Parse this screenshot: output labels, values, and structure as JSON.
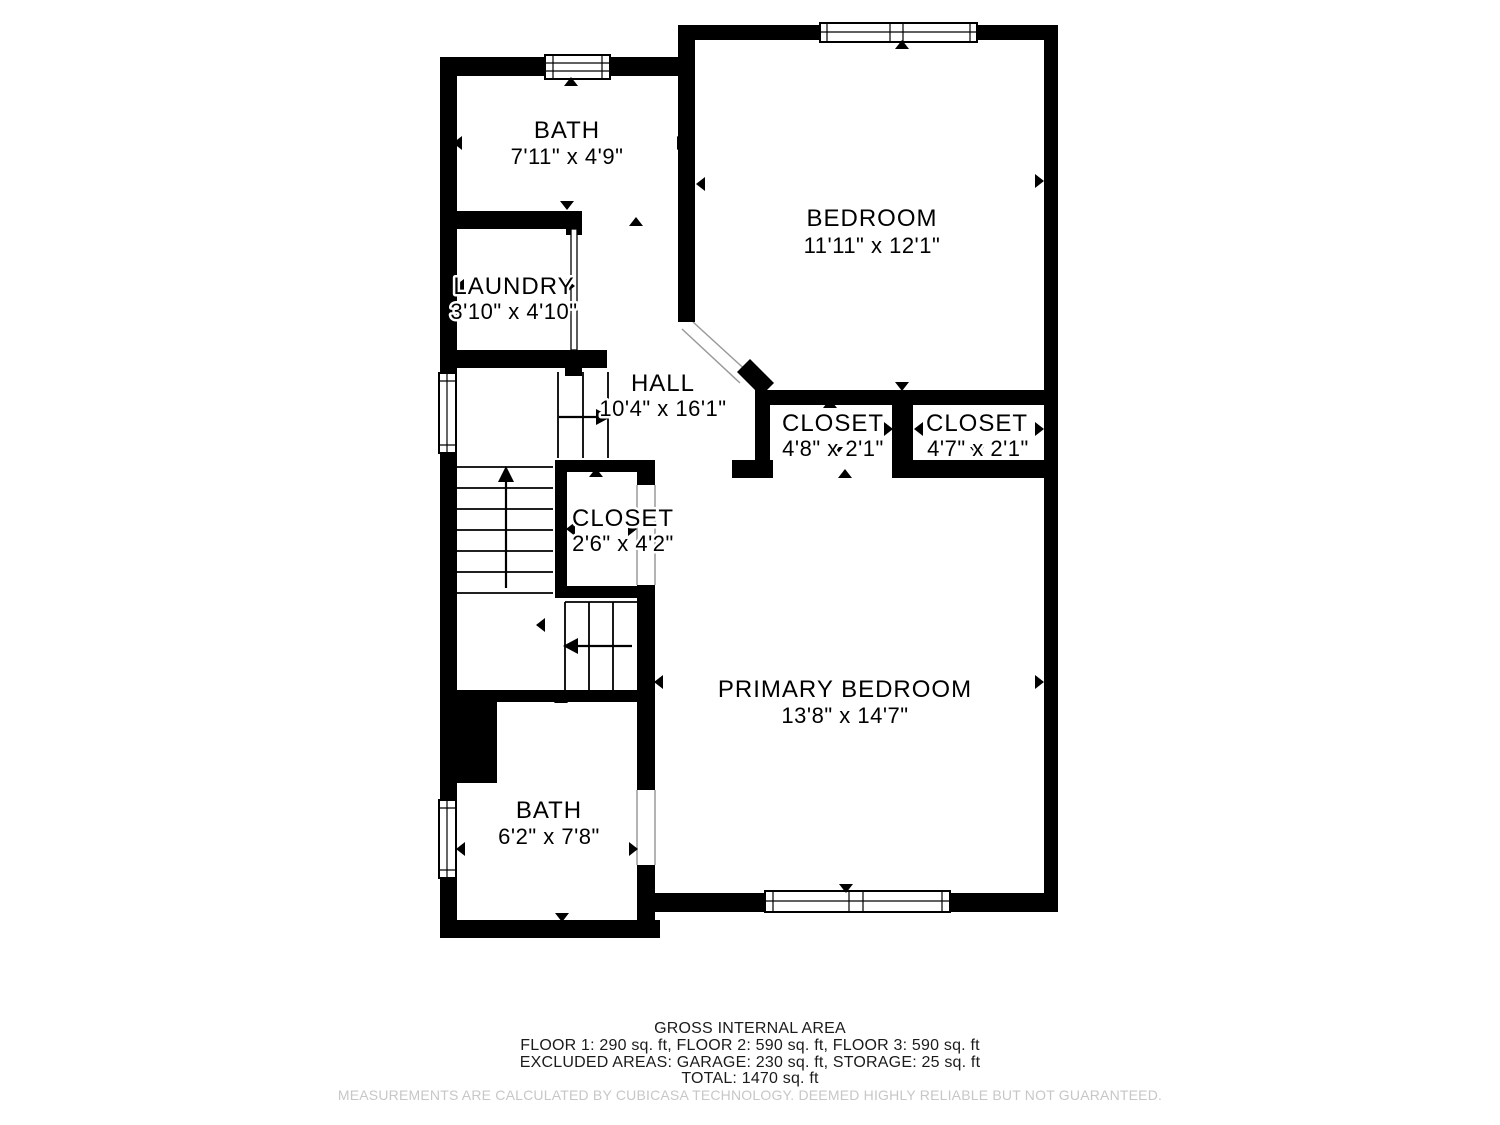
{
  "plan": {
    "title": "floor-plan-third-floor",
    "colors": {
      "wall": "#000000",
      "floor": "#ffffff",
      "label": "#000000",
      "door_guide": "#8a8a8a",
      "disclaimer_text": "#c7c7c7"
    },
    "rooms": [
      {
        "name": "BATH",
        "dims": "7'11\" x 4'9\""
      },
      {
        "name": "BEDROOM",
        "dims": "11'11\" x 12'1\""
      },
      {
        "name": "LAUNDRY",
        "dims": "3'10\" x 4'10\""
      },
      {
        "name": "HALL",
        "dims": "10'4\" x 16'1\""
      },
      {
        "name": "CLOSET",
        "dims": "4'8\" x 2'1\""
      },
      {
        "name": "CLOSET",
        "dims": "4'7\" x 2'1\""
      },
      {
        "name": "CLOSET",
        "dims": "2'6\" x 4'2\""
      },
      {
        "name": "PRIMARY BEDROOM",
        "dims": "13'8\" x 14'7\""
      },
      {
        "name": "BATH",
        "dims": "6'2\" x 7'8\""
      }
    ]
  },
  "footer": {
    "title": "GROSS INTERNAL AREA",
    "floors_line": "FLOOR 1: 290 sq. ft, FLOOR 2: 590 sq. ft, FLOOR 3: 590 sq. ft",
    "excluded_line": "EXCLUDED AREAS: GARAGE: 230 sq. ft, STORAGE: 25 sq. ft",
    "total_line": "TOTAL: 1470 sq. ft",
    "disclaimer": "MEASUREMENTS ARE CALCULATED BY CUBICASA TECHNOLOGY. DEEMED HIGHLY RELIABLE BUT NOT GUARANTEED."
  }
}
